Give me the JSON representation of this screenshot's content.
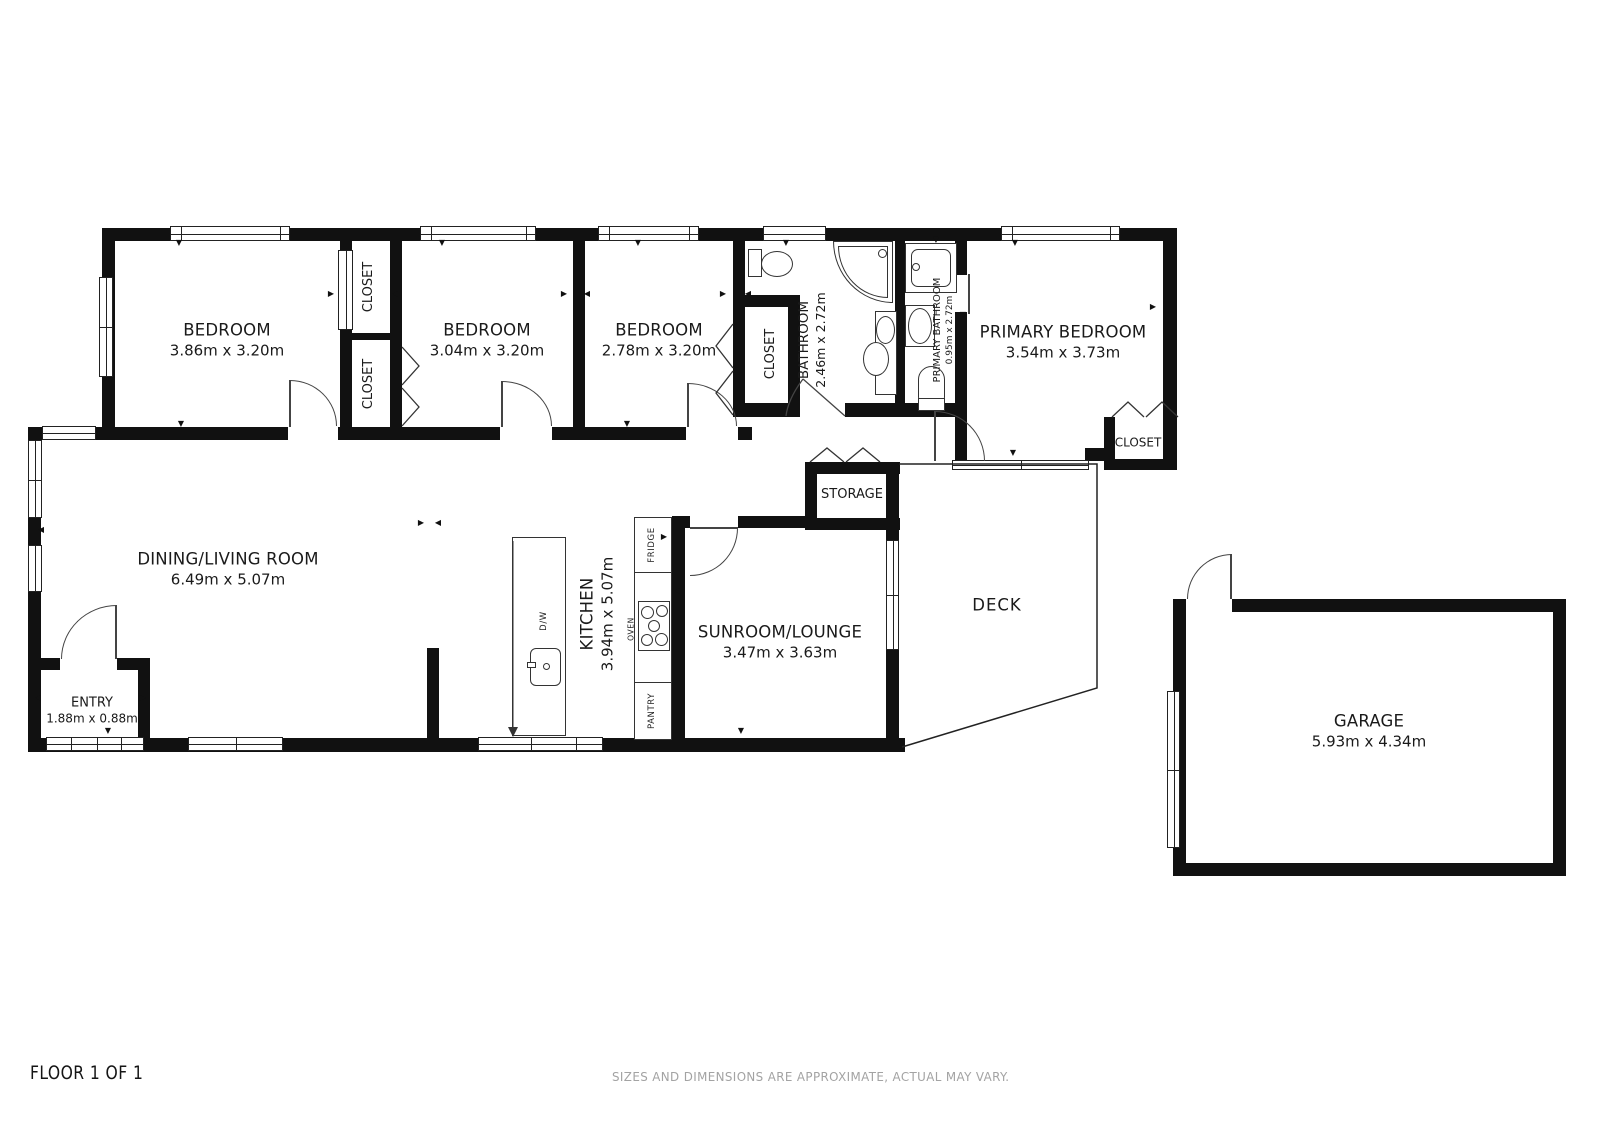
{
  "colors": {
    "wall": "#111111",
    "line": "#333333",
    "text": "#1a1a1a",
    "muted": "#a3a3a3"
  },
  "rooms": {
    "bedroom_1": {
      "name": "BEDROOM",
      "dims": "3.86m x 3.20m"
    },
    "bedroom_2": {
      "name": "BEDROOM",
      "dims": "3.04m x 3.20m"
    },
    "bedroom_3": {
      "name": "BEDROOM",
      "dims": "2.78m x 3.20m"
    },
    "primary_bedroom": {
      "name": "PRIMARY BEDROOM",
      "dims": "3.54m x 3.73m"
    },
    "bathroom": {
      "name": "BATHROOM",
      "dims": "2.46m x 2.72m"
    },
    "primary_bathroom": {
      "name": "PRIMARY BATHROOM",
      "dims": "0.95m x 2.72m"
    },
    "dining_living_room": {
      "name": "DINING/LIVING ROOM",
      "dims": "6.49m x 5.07m"
    },
    "kitchen": {
      "name": "KITCHEN",
      "dims": "3.94m x 5.07m"
    },
    "sunroom_lounge": {
      "name": "SUNROOM/LOUNGE",
      "dims": "3.47m x 3.63m"
    },
    "entry": {
      "name": "ENTRY",
      "dims": "1.88m x 0.88m"
    },
    "garage": {
      "name": "GARAGE",
      "dims": "5.93m x 4.34m"
    },
    "deck": {
      "name": "DECK"
    },
    "storage": {
      "name": "STORAGE"
    },
    "closet_top": {
      "name": "CLOSET"
    },
    "closet_bottom": {
      "name": "CLOSET"
    },
    "closet_bed3": {
      "name": "CLOSET"
    },
    "closet_primary": {
      "name": "CLOSET"
    }
  },
  "appliances": {
    "fridge": "FRIDGE",
    "oven": "OVEN",
    "pantry": "PANTRY",
    "dishwasher": "D/W"
  },
  "glyphs": {
    "tri_up": "▲",
    "tri_down": "▼",
    "tri_left": "◀",
    "tri_right": "▶"
  },
  "footer": {
    "floor_label": "FLOOR 1 OF 1",
    "disclaimer": "SIZES AND DIMENSIONS ARE APPROXIMATE, ACTUAL MAY VARY."
  }
}
